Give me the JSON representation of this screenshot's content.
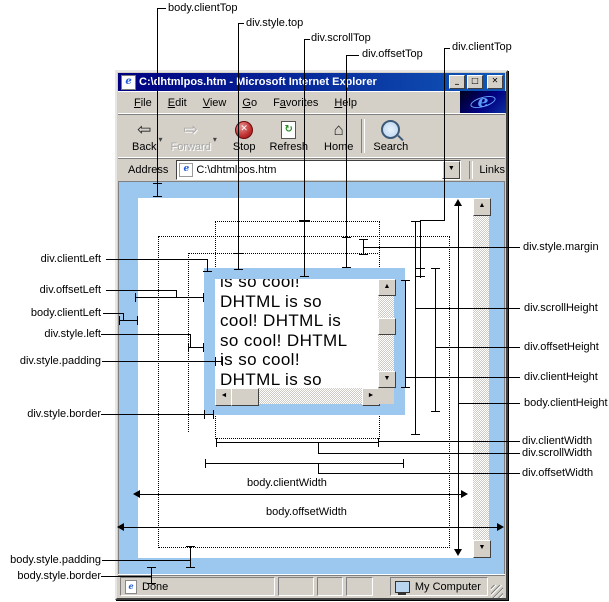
{
  "window": {
    "title": "C:\\dhtmlpos.htm - Microsoft Internet Explorer"
  },
  "menu": {
    "items": [
      {
        "label": "File",
        "u": 0
      },
      {
        "label": "Edit",
        "u": 0
      },
      {
        "label": "View",
        "u": 0
      },
      {
        "label": "Go",
        "u": 0
      },
      {
        "label": "Favorites",
        "u": 1
      },
      {
        "label": "Help",
        "u": 0
      }
    ]
  },
  "toolbar": {
    "buttons": [
      {
        "label": "Back"
      },
      {
        "label": "Forward"
      },
      {
        "label": "Stop"
      },
      {
        "label": "Refresh"
      },
      {
        "label": "Home"
      },
      {
        "label": "Search"
      }
    ]
  },
  "address": {
    "label": "Address",
    "value": "C:\\dhtmlpos.htm",
    "links_label": "Links"
  },
  "status": {
    "done": "Done",
    "my_computer": "My Computer"
  },
  "content_div": {
    "text": "is so cool!\nDHTML is so\ncool! DHTML is\nso cool! DHTML\nis so cool!\nDHTML is so\ncool! DHTML is"
  },
  "ann": {
    "body_clientTop": "body.clientTop",
    "div_style_top": "div.style.top",
    "div_scrollTop": "div.scrollTop",
    "div_offsetTop": "div.offsetTop",
    "div_clientTop": "div.clientTop",
    "div_clientLeft": "div.clientLeft",
    "div_offsetLeft": "div.offsetLeft",
    "body_clientLeft": "body.clientLeft",
    "div_style_left": "div.style.left",
    "div_style_padding": "div.style.padding",
    "div_style_border": "div.style.border",
    "div_style_margin": "div.style.margin",
    "div_scrollHeight": "div.scrollHeight",
    "div_offsetHeight": "div.offsetHeight",
    "div_clientHeight": "div.clientHeight",
    "body_clientHeight": "body.clientHeight",
    "div_clientWidth": "div.clientWidth",
    "div_scrollWidth": "div.scrollWidth",
    "div_offsetWidth": "div.offsetWidth",
    "body_clientWidth": "body.clientWidth",
    "body_offsetWidth": "body.offsetWidth",
    "body_style_padding": "body.style.padding",
    "body_style_border": "body.style.border"
  },
  "colors": {
    "accent_blue": "#9CC7EE",
    "title_bar_blue": "#000080",
    "chrome_gray": "#D4D0C8"
  }
}
